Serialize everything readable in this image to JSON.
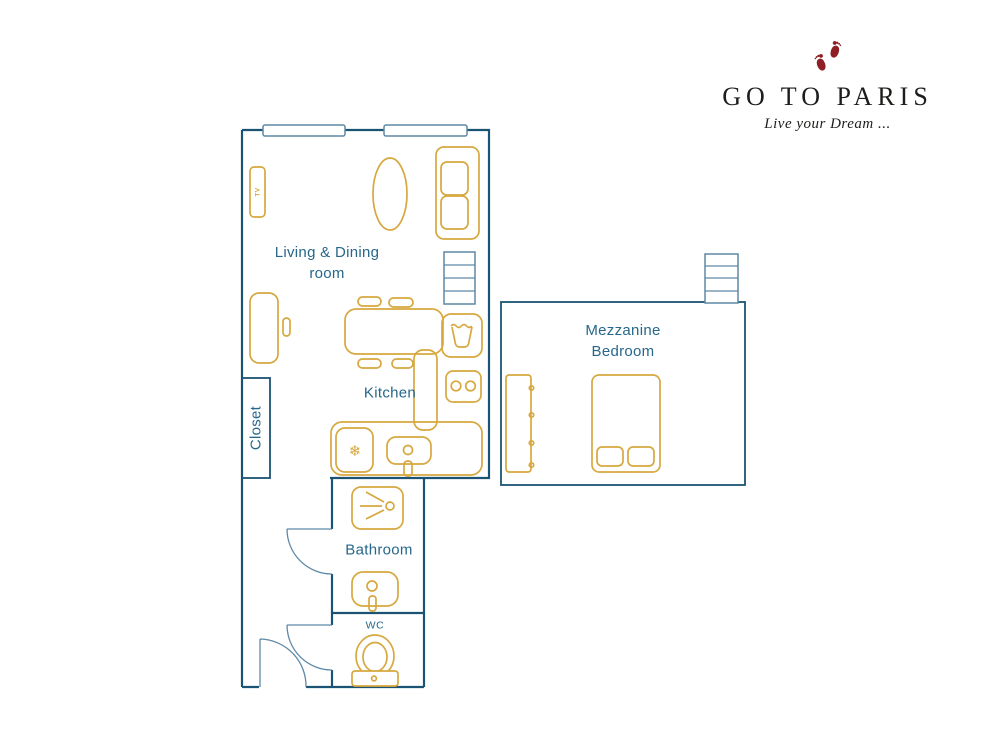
{
  "brand": {
    "name": "GO TO PARIS",
    "tagline": "Live your Dream ..."
  },
  "rooms": {
    "living_dining": {
      "line1": "Living & Dining",
      "line2": "room"
    },
    "kitchen": {
      "label": "Kitchen"
    },
    "closet": {
      "label": "Closet"
    },
    "bathroom": {
      "label": "Bathroom"
    },
    "wc": {
      "label": "WC"
    },
    "mezzanine_bedroom": {
      "line1": "Mezzanine",
      "line2": "Bedroom"
    }
  },
  "furniture_labels": {
    "tv": "TV"
  },
  "icons": {
    "fridge_snowflake": "❄",
    "footprints": "two-red-baby-footprints"
  },
  "colors": {
    "wall": "#1a5373",
    "fixture": "#5e89a6",
    "furniture": "#d7a83f",
    "label": "#26678a",
    "brandRed": "#8e1f26",
    "brandText": "#1d1d1b"
  }
}
